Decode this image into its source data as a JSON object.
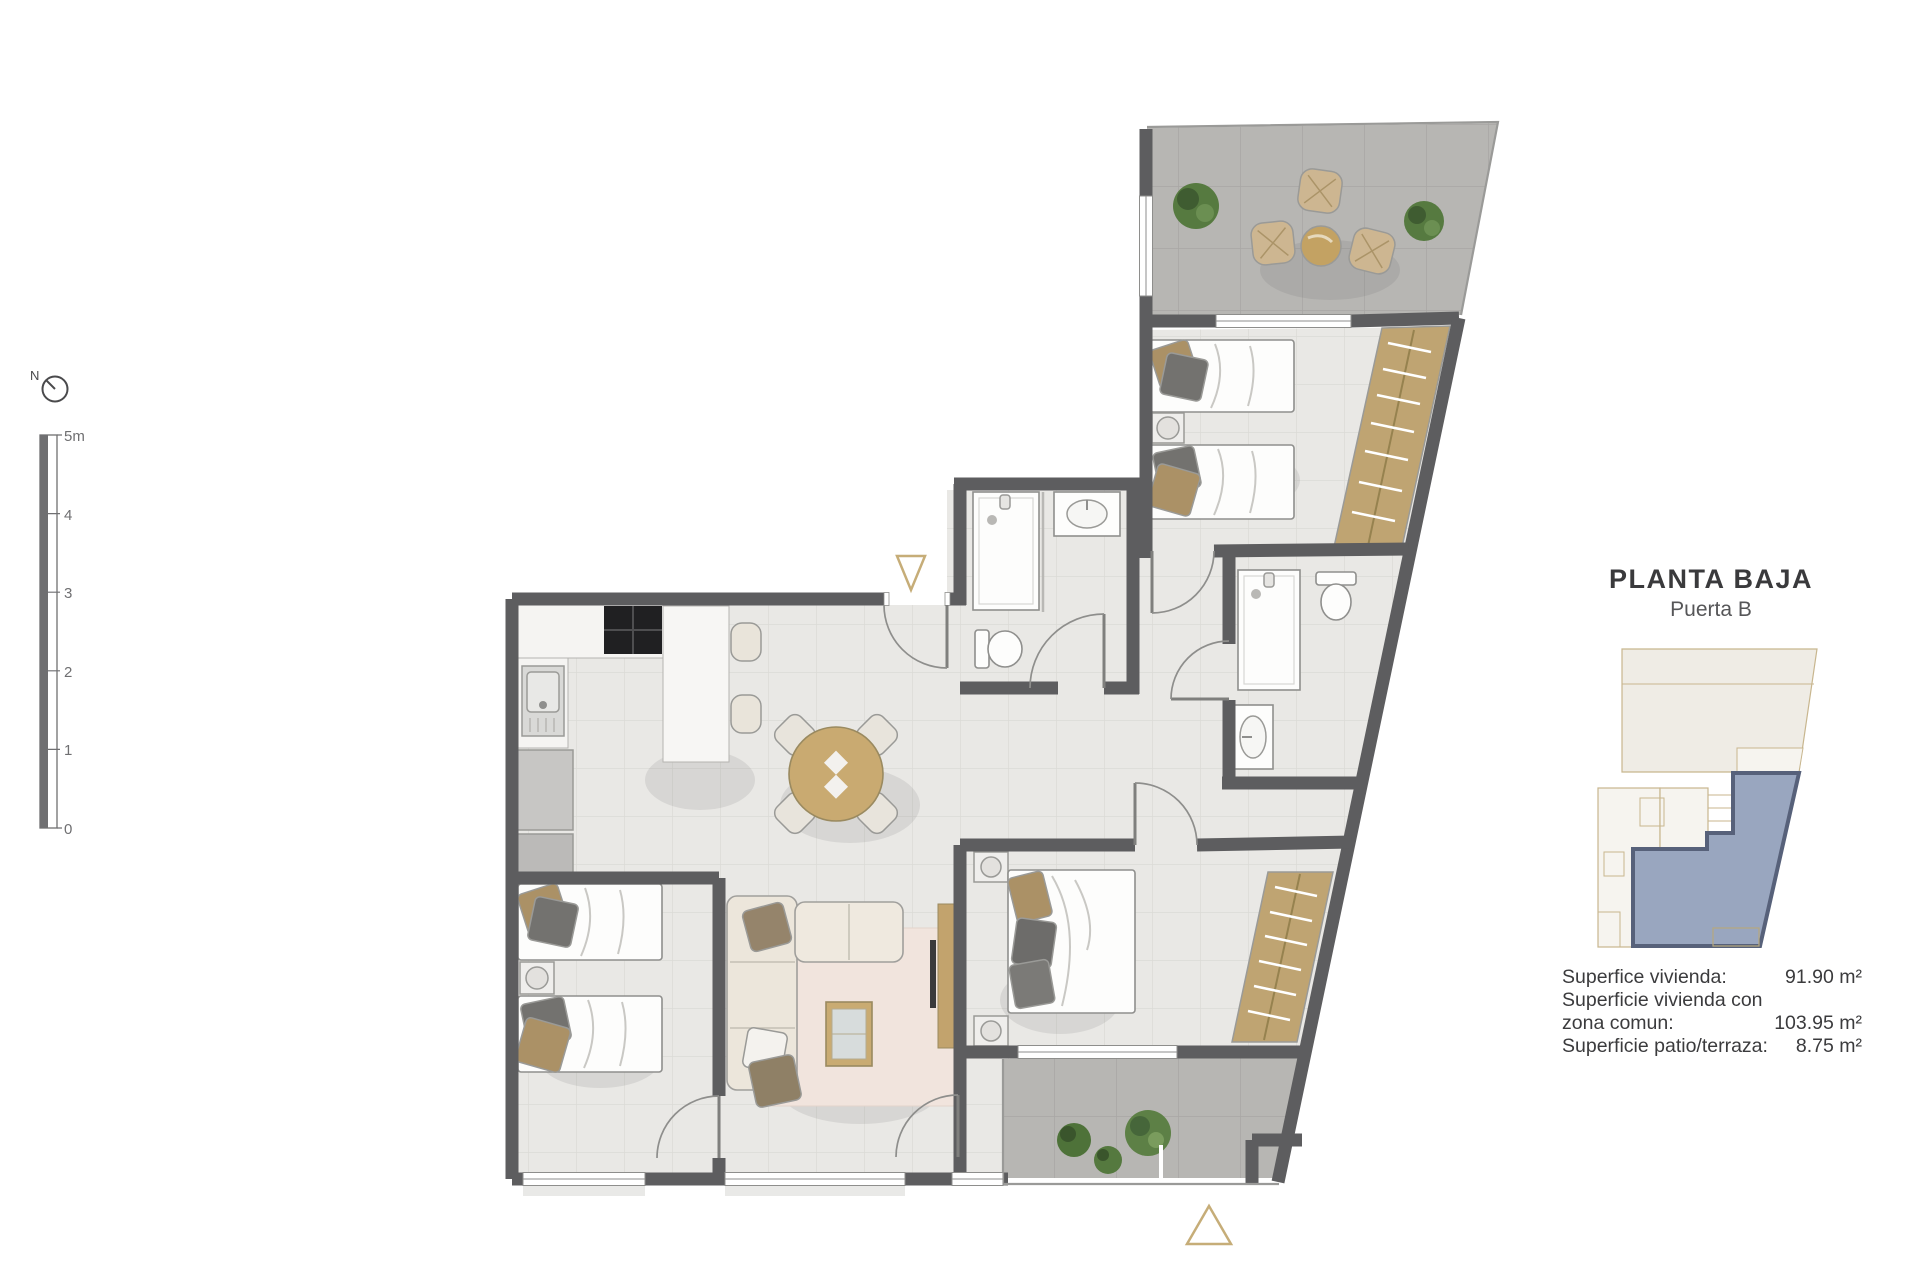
{
  "page": {
    "background": "#ffffff"
  },
  "compass": {
    "label": "N"
  },
  "scale_bar": {
    "ticks": [
      "5m",
      "4",
      "3",
      "2",
      "1",
      "0"
    ]
  },
  "panel": {
    "title": "PLANTA BAJA",
    "subtitle": "Puerta B",
    "areas": [
      {
        "label": "Superfice vivienda:",
        "value": "91.90 m²"
      },
      {
        "label": "Superficie vivienda con",
        "value": ""
      },
      {
        "label": "zona comun:",
        "value": "103.95 m²"
      },
      {
        "label": "Superficie patio/terraza:",
        "value": "8.75 m²"
      }
    ]
  },
  "colors": {
    "wall": "#5d5d5f",
    "accent_gold": "#c6ad78",
    "floor_light": "#e9e8e5",
    "floor_dark": "#b7b6b3",
    "wood": "#c5a76f",
    "minimap_highlight_fill": "#99a6bf",
    "minimap_highlight_border": "#57617a",
    "minimap_line": "#c8b68e",
    "text_dark": "#3b3b3d"
  }
}
